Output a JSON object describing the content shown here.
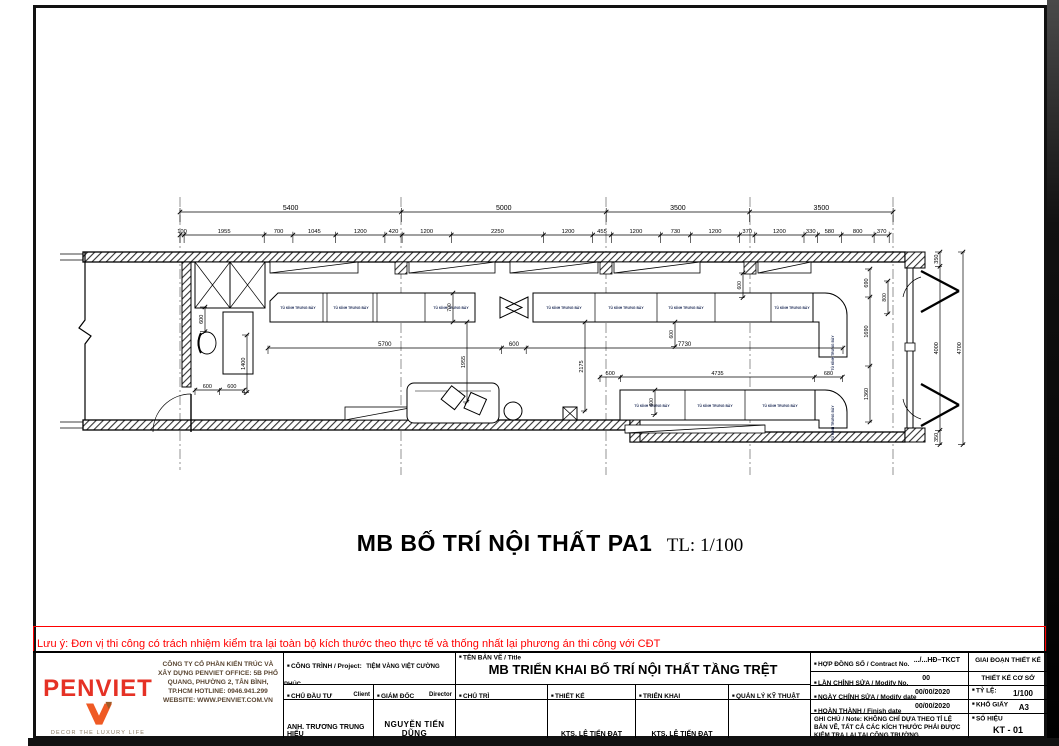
{
  "main_title": {
    "text": "MB BỐ TRÍ NỘI THẤT PA1",
    "scale": "TL: 1/100"
  },
  "note": {
    "text": "Lưu ý: Đơn vị thi công có trách nhiệm kiểm tra lại toàn bộ kích thước theo thực tế và thống nhất lại phương án thi công với CĐT",
    "color": "#ff0000"
  },
  "plan": {
    "counter_label": "TỦ KÍNH TRƯNG BÀY",
    "dims": {
      "top": [
        "5400",
        "5000",
        "3500",
        "3500"
      ],
      "sub": [
        "100",
        "1955",
        "700",
        "1045",
        "1200",
        "420",
        "1200",
        "2250",
        "1200",
        "455",
        "1200",
        "730",
        "1200",
        "370",
        "1200",
        "330",
        "580",
        "800",
        "370"
      ],
      "aisle": [
        "5700",
        "600",
        "7730"
      ],
      "lower": [
        "500",
        "4735",
        "680"
      ],
      "right_v": [
        "690",
        "1690",
        "1360"
      ],
      "front": [
        "350",
        "4000",
        "350"
      ],
      "front_total": [
        "4700"
      ],
      "left_v600": [
        "600"
      ],
      "left_v1400": [
        "1400"
      ],
      "left_h": [
        "600",
        "600"
      ],
      "mid_1955": [
        "1955"
      ],
      "mid_2175": [
        "2175"
      ],
      "mid_700": [
        "700"
      ],
      "d600a": [
        "600"
      ],
      "d600b": [
        "600"
      ],
      "d600c": [
        "600"
      ],
      "d800": [
        "800"
      ]
    }
  },
  "titleblock": {
    "logo": {
      "name": "PENVIET",
      "tagline": "DECOR THE LUXURY LIFE"
    },
    "company": "CÔNG TY CỔ PHẦN KIẾN TRÚC VÀ XÂY DỰNG PENVIET OFFICE: 5B PHỔ QUANG, PHƯỜNG 2, TÂN BÌNH, TP.HCM HOTLINE: 0946.941.299 WEBSITE: WWW.PENVIET.COM.VN",
    "project_label": "CÔNG TRÌNH / Project:",
    "project_value": "TIỆM VÀNG VIỆT CƯỜNG PHÚC",
    "address_label": "ĐỊA CHỈ / Address:",
    "address_value": "3022 QUANG TRUNG, BỒNG SƠN, GIA LAI",
    "client_label": "CHỦ ĐẦU TƯ",
    "client_sub": "Client",
    "client_value": "ANH. TRƯƠNG TRUNG HIẾU",
    "director_label": "GIÁM ĐỐC",
    "director_sub": "Director",
    "director_value": "NGUYỄN TIẾN DŨNG",
    "title_label": "TÊN BẢN VẼ / Title",
    "title_value": "MB TRIỂN KHAI BỐ TRÍ NỘI THẤT  TẦNG TRỆT",
    "chutri_label": "CHỦ TRÌ",
    "thietke_label": "THIẾT KẾ",
    "thietke_value": "KTS.  LÊ TIẾN ĐẠT",
    "trienkhai_label": "TRIỂN KHAI",
    "trienkhai_value": "KTS.  LÊ TIẾN ĐẠT",
    "qlkt_label": "QUẢN LÝ KỸ THUẬT",
    "contract_label": "HỢP ĐỒNG SỐ / Contract No.",
    "contract_value": ".../...HĐ–TKCT",
    "modify_no_label": "LẦN CHỈNH SỬA / Modify No.",
    "modify_no_value": "00",
    "modify_date_label": "NGÀY CHỈNH SỬA / Modify date",
    "modify_date_value": "00/00/2020",
    "finish_label": "HOÀN THÀNH / Finish date",
    "finish_value": "00/00/2020",
    "ghichu_label": "GHI CHÚ / Note:",
    "ghichu_value": "KHÔNG CHỈ DỰA THEO TỈ LỆ BẢN VẼ, TẤT CẢ CÁC KÍCH THƯỚC PHẢI ĐƯỢC KIỂM TRA LẠI TẠI CÔNG TRƯỜNG.",
    "stage_label": "GIAI  ĐOẠN THIẾT KẾ",
    "stage_value": "THIẾT KẾ CƠ SỞ",
    "scale_label": "TỶ LỆ:",
    "scale_value": "1/100",
    "paper_label": "KHỔ GIẤY",
    "paper_value": "A3",
    "sheet_label": "SỐ HIỆU",
    "sheet_value": "KT - 01"
  }
}
